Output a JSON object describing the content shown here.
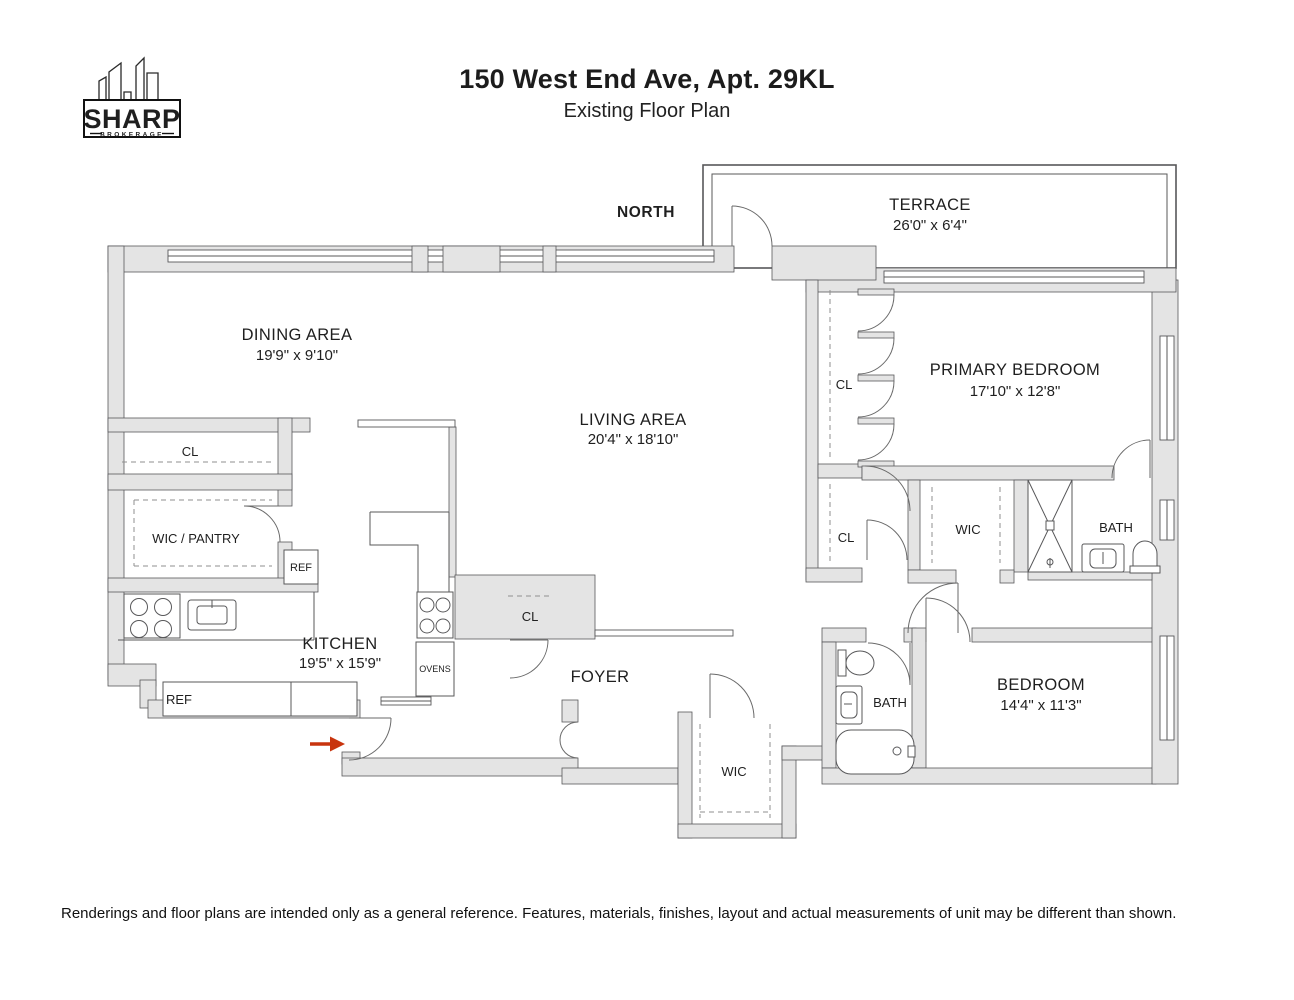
{
  "header": {
    "title": "150 West End Ave, Apt. 29KL",
    "subtitle": "Existing Floor Plan"
  },
  "logo": {
    "name": "SHARP",
    "tagline": "BROKERAGE"
  },
  "plan": {
    "north_label": "NORTH",
    "rooms": {
      "terrace": {
        "name": "TERRACE",
        "dims": "26'0\" x 6'4\""
      },
      "dining": {
        "name": "DINING AREA",
        "dims": "19'9\" x 9'10\""
      },
      "living": {
        "name": "LIVING AREA",
        "dims": "20'4\" x 18'10\""
      },
      "primary_bedroom": {
        "name": "PRIMARY BEDROOM",
        "dims": "17'10\" x 12'8\""
      },
      "kitchen": {
        "name": "KITCHEN",
        "dims": "19'5\" x 15'9\""
      },
      "foyer": {
        "name": "FOYER"
      },
      "bedroom": {
        "name": "BEDROOM",
        "dims": "14'4\" x 11'3\""
      }
    },
    "fixtures": {
      "closet": "CL",
      "walk_in_closet": "WIC",
      "wic_pantry": "WIC / PANTRY",
      "bath": "BATH",
      "refrigerator": "REF",
      "ovens": "OVENS"
    }
  },
  "footer": {
    "disclaimer": "Renderings and floor plans are intended only as a general reference. Features, materials, finishes, layout and actual measurements of unit may be different than shown."
  },
  "colors": {
    "entry_arrow": "#c8340e",
    "wall_fill": "#e4e4e4"
  }
}
